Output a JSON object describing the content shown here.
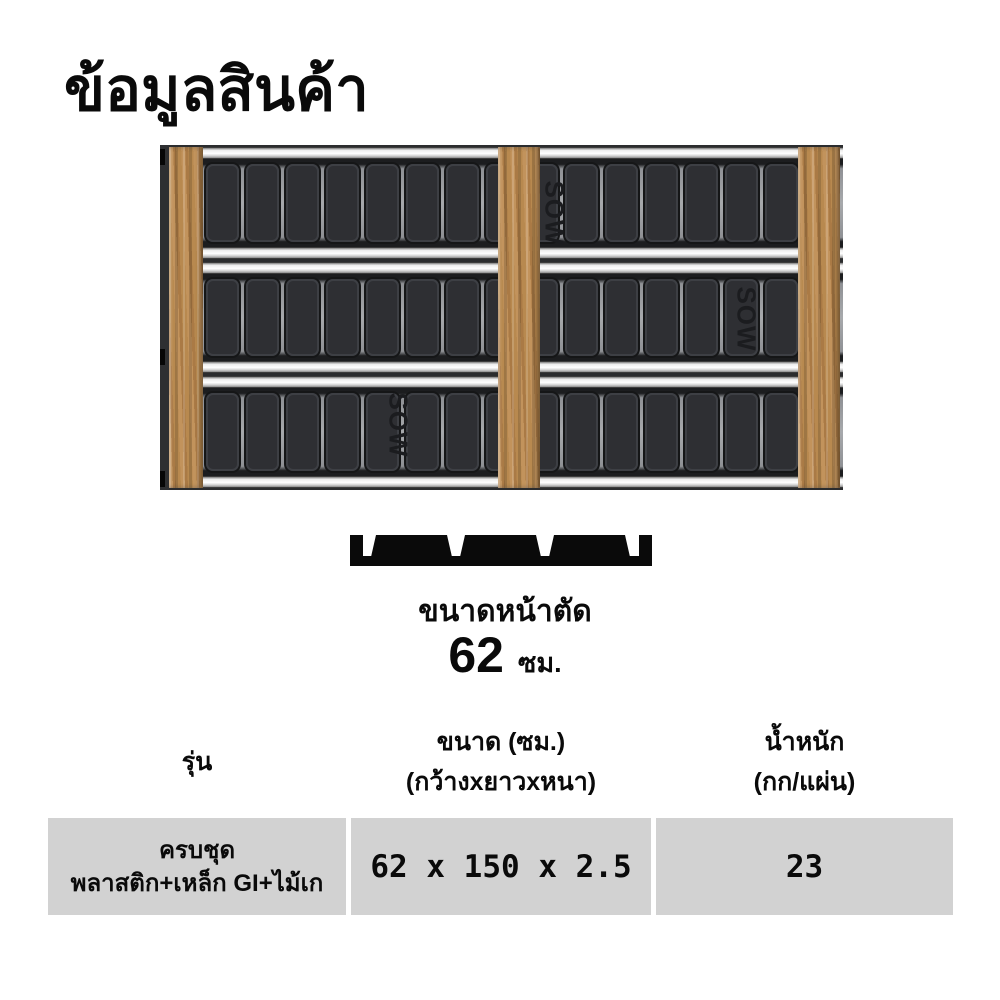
{
  "title": "ข้อมูลสินค้า",
  "product_image": {
    "brand_logo_text": "SOW",
    "rows": 3,
    "slats_per_row": 15,
    "colors": {
      "wood": "#b5854f",
      "slat": "#2e2f33",
      "rail": "#ffffff",
      "frame": "#2b2c2e"
    }
  },
  "cross_section": {
    "label": "ขนาดหน้าตัด",
    "value": "62",
    "unit": "ซม."
  },
  "spec_table": {
    "cell_bg": "#d2d2d2",
    "columns": [
      {
        "line1": "รุ่น",
        "line2": ""
      },
      {
        "line1": "ขนาด (ซม.)",
        "line2": "(กว้างxยาวxหนา)"
      },
      {
        "line1": "น้ำหนัก",
        "line2": "(กก/แผ่น)"
      }
    ],
    "rows": [
      {
        "model_line1": "ครบชุด",
        "model_line2": "พลาสติก+เหล็ก GI+ไม้เก",
        "size": "62 x 150 x 2.5",
        "weight": "23"
      }
    ]
  }
}
